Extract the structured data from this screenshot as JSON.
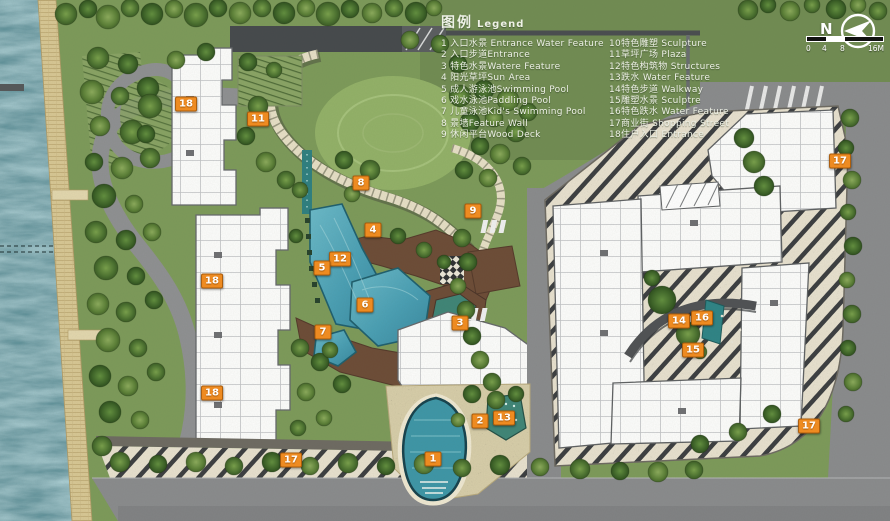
{
  "legend": {
    "title_zh": "图例",
    "title_en": "Legend",
    "col1": [
      {
        "text": "1 入口水景 Entrance Water Feature"
      },
      {
        "text": "2 入口步道Entrance"
      },
      {
        "text": "3 特色水景Watere Feature"
      },
      {
        "text": "4 阳光草坪Sun Area"
      },
      {
        "text": "5 成人游泳池Swimming Pool"
      },
      {
        "text": "6 戏水泳池Paddling Pool"
      },
      {
        "text": "7 儿童泳池Kid's Swimming Pool"
      },
      {
        "text": "8 景墙Feature Wall"
      },
      {
        "text": "9 休闲平台Wood Deck"
      }
    ],
    "col2": [
      {
        "text": "10特色雕塑 Sculpture"
      },
      {
        "text": "11草坪广场 Plaza"
      },
      {
        "text": "12特色构筑物 Structures"
      },
      {
        "text": "13跌水 Water Feature"
      },
      {
        "text": "14特色步道 Walkway"
      },
      {
        "text": "15雕塑水景 Sculptre"
      },
      {
        "text": "16特色跌水 Water Feature"
      },
      {
        "text": "17商业街 Shopping Street"
      },
      {
        "text": "18住户入口 Entrance"
      }
    ]
  },
  "compass": {
    "label": "N"
  },
  "scale": {
    "ticks": [
      "0",
      "4",
      "8",
      "16M"
    ]
  },
  "markers": [
    {
      "n": "18",
      "x": 186,
      "y": 104
    },
    {
      "n": "11",
      "x": 258,
      "y": 119
    },
    {
      "n": "8",
      "x": 361,
      "y": 183
    },
    {
      "n": "9",
      "x": 473,
      "y": 211
    },
    {
      "n": "4",
      "x": 373,
      "y": 230
    },
    {
      "n": "12",
      "x": 340,
      "y": 259
    },
    {
      "n": "5",
      "x": 322,
      "y": 268
    },
    {
      "n": "6",
      "x": 365,
      "y": 305
    },
    {
      "n": "7",
      "x": 323,
      "y": 332
    },
    {
      "n": "3",
      "x": 460,
      "y": 323
    },
    {
      "n": "18",
      "x": 212,
      "y": 281
    },
    {
      "n": "18",
      "x": 212,
      "y": 393
    },
    {
      "n": "14",
      "x": 679,
      "y": 321
    },
    {
      "n": "16",
      "x": 702,
      "y": 318
    },
    {
      "n": "15",
      "x": 693,
      "y": 350
    },
    {
      "n": "2",
      "x": 480,
      "y": 421
    },
    {
      "n": "13",
      "x": 504,
      "y": 418
    },
    {
      "n": "1",
      "x": 433,
      "y": 459
    },
    {
      "n": "17",
      "x": 291,
      "y": 460
    },
    {
      "n": "17",
      "x": 840,
      "y": 161
    },
    {
      "n": "17",
      "x": 809,
      "y": 426
    }
  ],
  "colors": {
    "marker": "#ee8b21",
    "water": "#2e6e78",
    "pool": "#4da3b8",
    "grass": "#7d9a5a",
    "road": "#8a8b8d",
    "deck": "#6d4c37",
    "sand": "#d8c794",
    "street_paving": "#e8e1cf"
  }
}
